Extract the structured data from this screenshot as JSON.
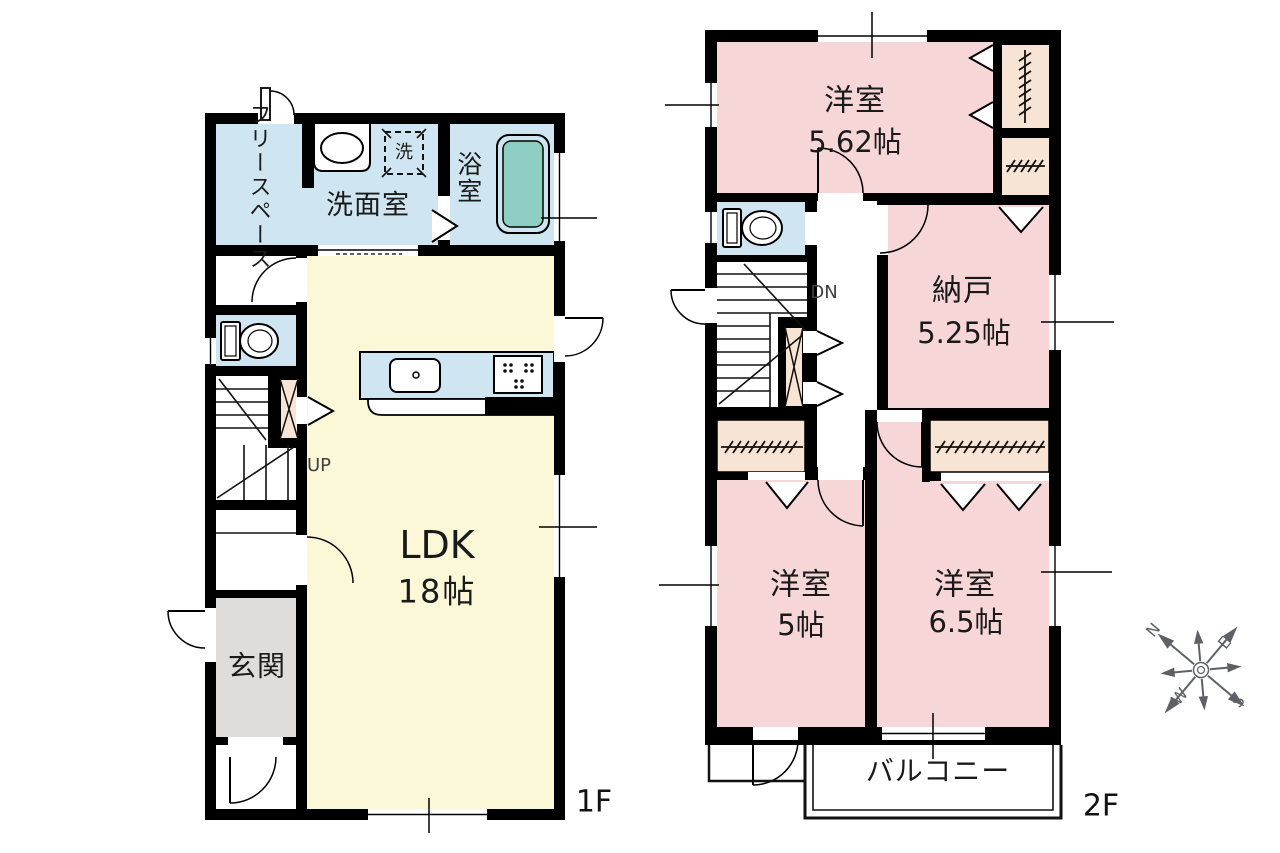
{
  "palette": {
    "wall": "#000000",
    "ldk_yellow": "#fbf8d7",
    "water_blue": "#cfe5f2",
    "bathtub_teal": "#8ecfc4",
    "bedroom_pink": "#f7d6d7",
    "closet_beige": "#f8e4d5",
    "genkan_gray": "#dedddb",
    "text_black": "#1a1a1a",
    "text_dim": "#3f3f3f",
    "compass_gray": "#5d6166"
  },
  "floor1": {
    "floor_label": "1F",
    "free_space_line1": "フリー",
    "free_space_line2": "スペース",
    "washroom": "洗面室",
    "laundry": "洗",
    "bathroom": "浴室",
    "ldk": "LDK",
    "ldk_size": "18帖",
    "genkan": "玄関",
    "stairs": "UP"
  },
  "floor2": {
    "floor_label": "2F",
    "bedroom1": "洋室",
    "bedroom1_size": "5.62帖",
    "storage": "納戸",
    "storage_size": "5.25帖",
    "bedroom2": "洋室",
    "bedroom2_size": "5帖",
    "bedroom3": "洋室",
    "bedroom3_size": "6.5帖",
    "balcony": "バルコニー",
    "stairs": "DN"
  },
  "compass": {
    "n": "N",
    "e": "E",
    "s": "S",
    "w": "W"
  }
}
